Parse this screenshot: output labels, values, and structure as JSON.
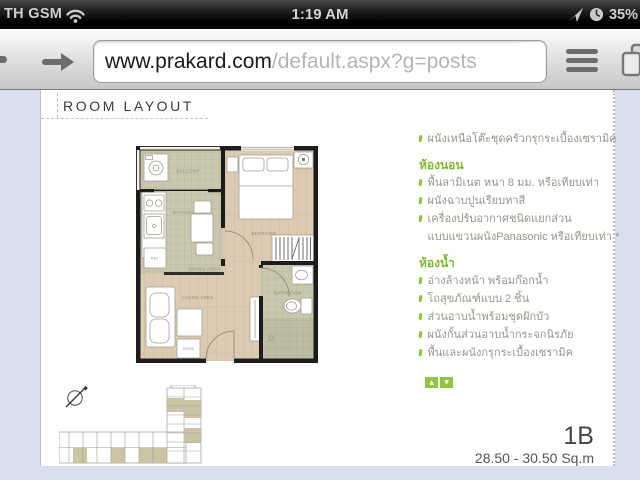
{
  "status_bar": {
    "carrier": "TH GSM",
    "time": "1:19 AM",
    "battery_percent": "35%"
  },
  "toolbar": {
    "url_host": "www.prakard.com",
    "url_path": "/default.aspx?g=posts"
  },
  "content": {
    "heading": "ROOM LAYOUT",
    "specs": {
      "intro_items": [
        {
          "text": "ผนังเหนือโต๊ะชุดครัวกรุกระเบื้องเซรามิค",
          "tick": true
        }
      ],
      "sections": [
        {
          "title": "ห้องนอน",
          "items": [
            {
              "text": "พื้นลามิเนต หนา 8 มม. หรือเทียบเท่า",
              "tick": true
            },
            {
              "text": "ผนังฉาบปูนเรียบทาสี",
              "tick": true
            },
            {
              "text": "เครื่องปรับอากาศชนิดแยกส่วน",
              "tick": true
            },
            {
              "text": "แบบแขวนผนังPanasonic หรือเทียบเท่า *",
              "tick": false
            }
          ]
        },
        {
          "title": "ห้องน้ำ",
          "items": [
            {
              "text": "อ่างล้างหน้า พร้อมก๊อกน้ำ",
              "tick": true
            },
            {
              "text": "โถสุขภัณฑ์แบบ 2 ชิ้น",
              "tick": true
            },
            {
              "text": "ส่วนอาบน้ำพร้อมชุดฝักบัว",
              "tick": true
            },
            {
              "text": "ผนังกั้นส่วนอาบน้ำกระจกนิรภัย",
              "tick": true
            },
            {
              "text": "พื้นและผนังกรุกระเบื้องเซรามิค",
              "tick": true
            }
          ]
        }
      ]
    },
    "unit": {
      "name": "1B",
      "area": "28.50 - 30.50 Sq.m"
    },
    "floor_plan": {
      "labels": {
        "balcony": "BALCONY",
        "kitchen": "KITCHEN",
        "dining": "DINING AREA",
        "bedroom": "BEDROOM",
        "living": "LIVING AREA",
        "bathroom": "BATHROOM",
        "ref": "REF",
        "shoe": "SHOE"
      }
    },
    "colors": {
      "accent_green": "#8dc63f",
      "page_bg": "#d9dfec",
      "tile": "#c9c7ad",
      "wood": "#dbcbb3",
      "wall": "#1c1c1c"
    }
  }
}
